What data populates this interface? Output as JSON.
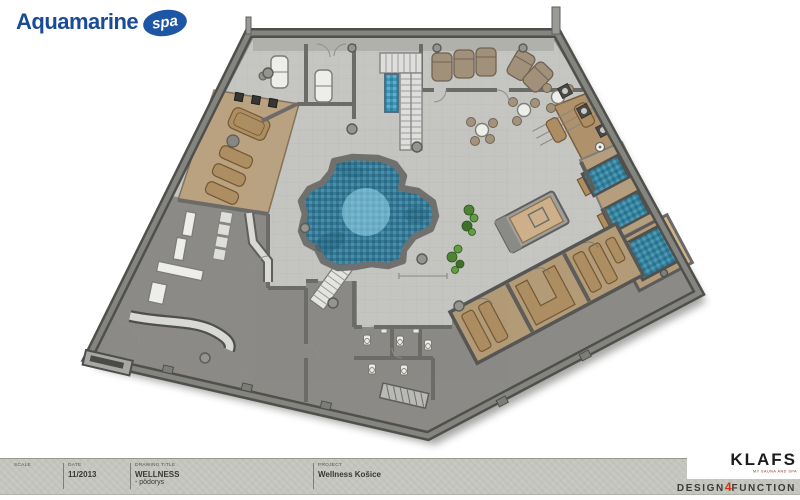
{
  "brand": {
    "name": "Aquamarine",
    "badge": "spa",
    "color": "#1a4b96",
    "badge_color": "#1e56a6"
  },
  "title_block": {
    "scale_label": "SCALE",
    "date_label": "DATE",
    "date_value": "11/2013",
    "drawing_title_label": "DRAWING TITLE",
    "drawing_title": "WELLNESS",
    "drawing_subtitle": "- pôdorys",
    "project_label": "PROJECT",
    "project_value": "Wellness Košice"
  },
  "logos": {
    "klafs": "KLAFS",
    "klafs_tagline": "MY SAUNA AND SPA",
    "design_prefix": "DESIGN",
    "design_accent": "4",
    "design_suffix": "FUNCTION"
  },
  "plan": {
    "type": "architectural-floor-plan",
    "shape": "pentagon wellness level",
    "colors": {
      "outer_wall": "#4f4f4c",
      "floor_light": "#e3e3df",
      "floor_dark": "#a09f9b",
      "wood_deck": "#d6bb95",
      "bench_wood": "#c7a271",
      "pool_water": "#357b97",
      "plunge_water": "#3f97b7",
      "plant_green": "#4e8434"
    },
    "features": [
      "free-form-pool",
      "pool-stairs",
      "l-staircase",
      "massage-tables",
      "wood-sun-deck",
      "deck-loungers",
      "changing-lockers",
      "reception-counter",
      "wc-toilets",
      "shower-bank",
      "sauna-benches",
      "plunge-pools",
      "cold-plunge-pool",
      "steam-table",
      "cafe-tables",
      "relax-loungers",
      "plants",
      "columns"
    ]
  }
}
